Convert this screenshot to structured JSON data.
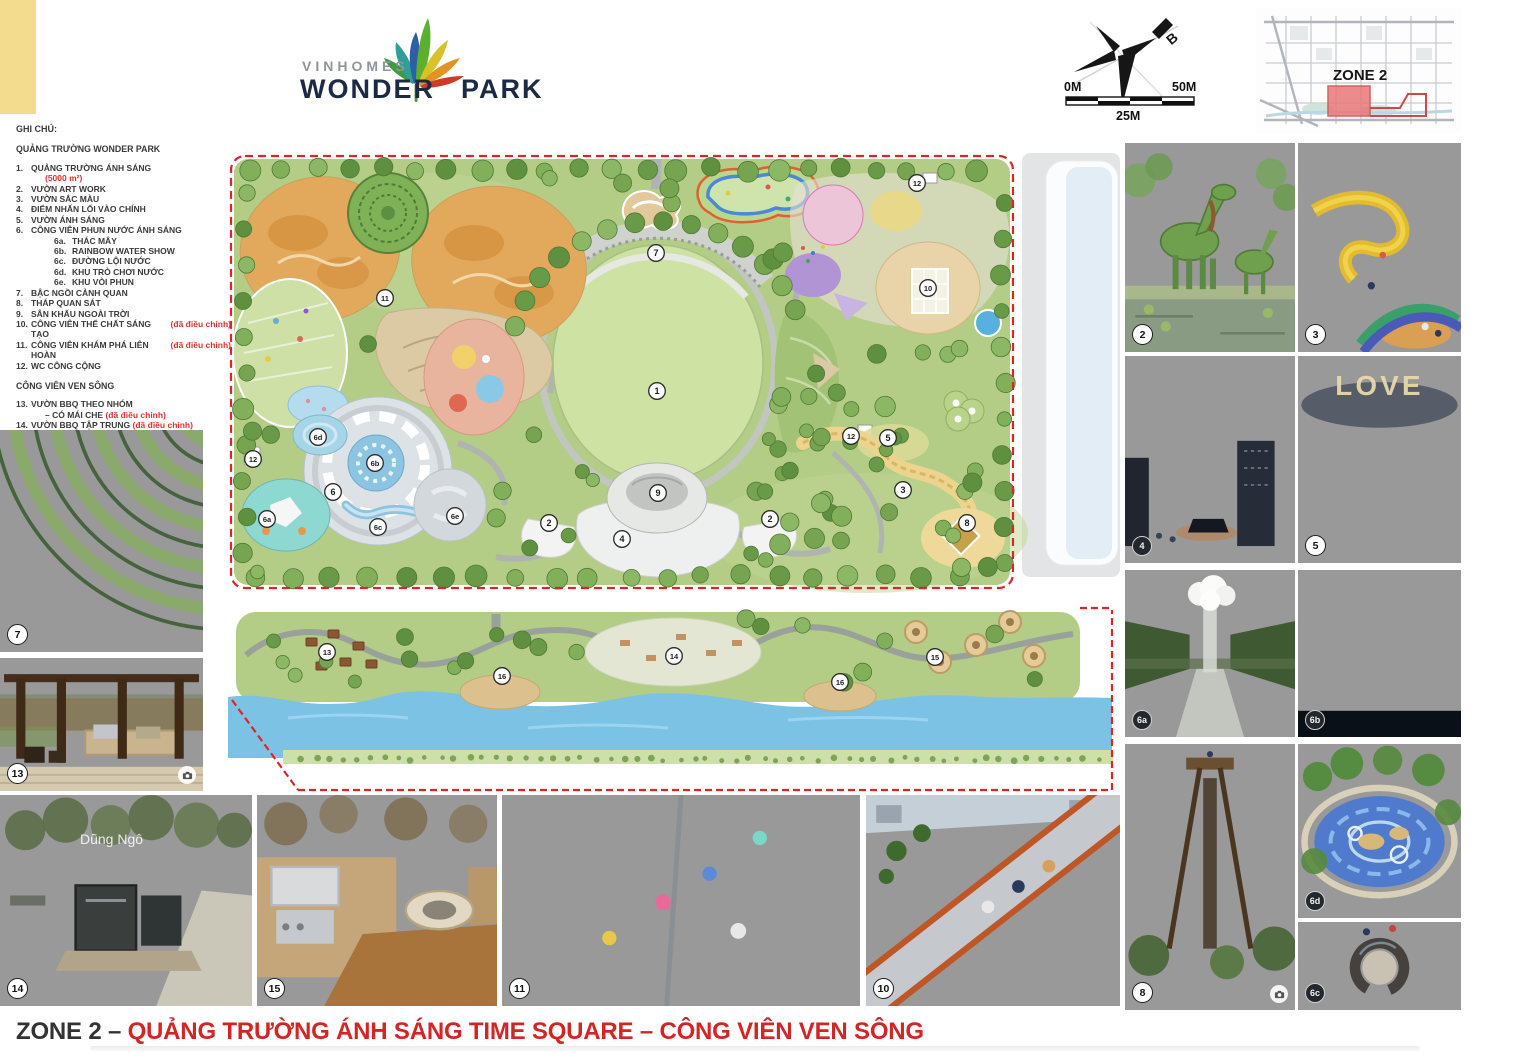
{
  "board": {
    "title_prefix": "ZONE 2 –",
    "title_main": " QUẢNG TRƯỜNG ÁNH SÁNG TIME SQUARE – CÔNG VIÊN VEN SÔNG"
  },
  "logo": {
    "brand": "VINHOMES",
    "name_left": "WONDER",
    "name_right": "PARK"
  },
  "compass": {
    "north_label": "B"
  },
  "scale_bar": {
    "start": "0M",
    "middle": "25M",
    "end": "50M"
  },
  "locator": {
    "label": "ZONE 2"
  },
  "legend": {
    "heading": "GHI CHÚ:",
    "sections": [
      {
        "title": "QUẢNG TRƯỜNG WONDER PARK",
        "lines": [
          {
            "num": "1.",
            "text": "QUẢNG TRƯỜNG ÁNH SÁNG",
            "red": "",
            "indent": 0
          },
          {
            "num": "",
            "text": "",
            "red": "(5000 m²)",
            "indent": 1
          },
          {
            "num": "2.",
            "text": "VƯỜN ART WORK",
            "red": "",
            "indent": 0
          },
          {
            "num": "3.",
            "text": "VƯỜN SẮC MÀU",
            "red": "",
            "indent": 0
          },
          {
            "num": "4.",
            "text": "ĐIỂM NHẤN LỐI VÀO CHÍNH",
            "red": "",
            "indent": 0
          },
          {
            "num": "5.",
            "text": "VƯỜN ÁNH SÁNG",
            "red": "",
            "indent": 0
          },
          {
            "num": "6.",
            "text": "CÔNG VIÊN PHUN NƯỚC ÁNH SÁNG",
            "red": "",
            "indent": 0
          },
          {
            "num": "6a.",
            "text": "THÁC MÂY",
            "red": "",
            "indent": 2
          },
          {
            "num": "6b.",
            "text": "RAINBOW WATER SHOW",
            "red": "",
            "indent": 2
          },
          {
            "num": "6c.",
            "text": "ĐƯỜNG LỘI NƯỚC",
            "red": "",
            "indent": 2
          },
          {
            "num": "6d.",
            "text": "KHU TRÒ CHƠI NƯỚC",
            "red": "",
            "indent": 2
          },
          {
            "num": "6e.",
            "text": "KHU VÒI PHUN",
            "red": "",
            "indent": 2
          },
          {
            "num": "7.",
            "text": "BẬC NGỒI CẢNH QUAN",
            "red": "",
            "indent": 0
          },
          {
            "num": "8.",
            "text": "THÁP QUAN SÁT",
            "red": "",
            "indent": 0
          },
          {
            "num": "9.",
            "text": "SÂN KHẤU NGOÀI TRỜI",
            "red": "",
            "indent": 0
          },
          {
            "num": "10.",
            "text": "CÔNG VIÊN THỂ CHẤT SÁNG TẠO",
            "red": "(đã điều chỉnh)",
            "indent": 0
          },
          {
            "num": "11.",
            "text": "CÔNG VIÊN KHÁM PHÁ LIÊN HOÀN",
            "red": "(đã điều chỉnh)",
            "indent": 0
          },
          {
            "num": "12.",
            "text": "WC CÔNG CỘNG",
            "red": "",
            "indent": 0
          }
        ]
      },
      {
        "title": "CÔNG VIÊN VEN SÔNG",
        "lines": [
          {
            "num": "13.",
            "text": "VƯỜN BBQ THEO NHÓM",
            "red": "",
            "indent": 0
          },
          {
            "num": "",
            "text": "– CÓ MÁI CHE",
            "red": " (đã điều chỉnh)",
            "indent": 1
          },
          {
            "num": "14.",
            "text": "VƯỜN BBQ TẬP TRUNG",
            "red": " (đã điều chỉnh)",
            "indent": 0
          },
          {
            "num": "15.",
            "text": "VƯỜN BBQ THEO NHÓM",
            "red": " (đã điều chỉnh)",
            "indent": 0
          },
          {
            "num": "16.",
            "text": "SÂN NGẮM CẢNH ĐA NĂNG",
            "red": "",
            "indent": 0
          }
        ]
      }
    ]
  },
  "plan": {
    "markers": [
      {
        "label": "7",
        "x": 428,
        "y": 100
      },
      {
        "label": "1",
        "x": 429,
        "y": 238
      },
      {
        "label": "9",
        "x": 430,
        "y": 340
      },
      {
        "label": "4",
        "x": 394,
        "y": 386
      },
      {
        "label": "2",
        "x": 321,
        "y": 370
      },
      {
        "label": "2",
        "x": 542,
        "y": 366
      },
      {
        "label": "11",
        "x": 157,
        "y": 145
      },
      {
        "label": "12",
        "x": 689,
        "y": 30
      },
      {
        "label": "10",
        "x": 700,
        "y": 135
      },
      {
        "label": "12",
        "x": 623,
        "y": 283
      },
      {
        "label": "5",
        "x": 660,
        "y": 285
      },
      {
        "label": "3",
        "x": 675,
        "y": 337
      },
      {
        "label": "8",
        "x": 739,
        "y": 370
      },
      {
        "label": "12",
        "x": 25,
        "y": 306
      },
      {
        "label": "6",
        "x": 105,
        "y": 339
      },
      {
        "label": "6a",
        "x": 39,
        "y": 366
      },
      {
        "label": "6b",
        "x": 147,
        "y": 310
      },
      {
        "label": "6c",
        "x": 150,
        "y": 374
      },
      {
        "label": "6d",
        "x": 90,
        "y": 284
      },
      {
        "label": "6e",
        "x": 227,
        "y": 363
      }
    ],
    "river_markers": [
      {
        "label": "13",
        "x": 99,
        "y": 52
      },
      {
        "label": "16",
        "x": 274,
        "y": 76
      },
      {
        "label": "14",
        "x": 446,
        "y": 56
      },
      {
        "label": "16",
        "x": 612,
        "y": 82
      },
      {
        "label": "15",
        "x": 707,
        "y": 57
      }
    ]
  },
  "photos": {
    "left": [
      {
        "badge": "7"
      },
      {
        "badge": "13"
      }
    ],
    "bottom": [
      {
        "badge": "14",
        "watermark": "Dũng Ngô"
      },
      {
        "badge": "15"
      },
      {
        "badge": "11"
      },
      {
        "badge": "10"
      }
    ],
    "right": [
      {
        "badge": "2"
      },
      {
        "badge": "3"
      },
      {
        "badge": "4"
      },
      {
        "badge": "5",
        "overlay": "LOVE"
      },
      {
        "badge": "6a"
      },
      {
        "badge": "6b"
      },
      {
        "badge": "8"
      },
      {
        "badge": "6d"
      },
      {
        "badge": "6c"
      }
    ]
  },
  "colors": {
    "accent_red": "#d42424",
    "legend_red": "#e03030",
    "dash_red": "#e02424",
    "water": "#7cc2e4",
    "lawn": "#cde2a3",
    "base_green": "#b3cc86",
    "swatch_yellow": "#f3dc8e"
  }
}
